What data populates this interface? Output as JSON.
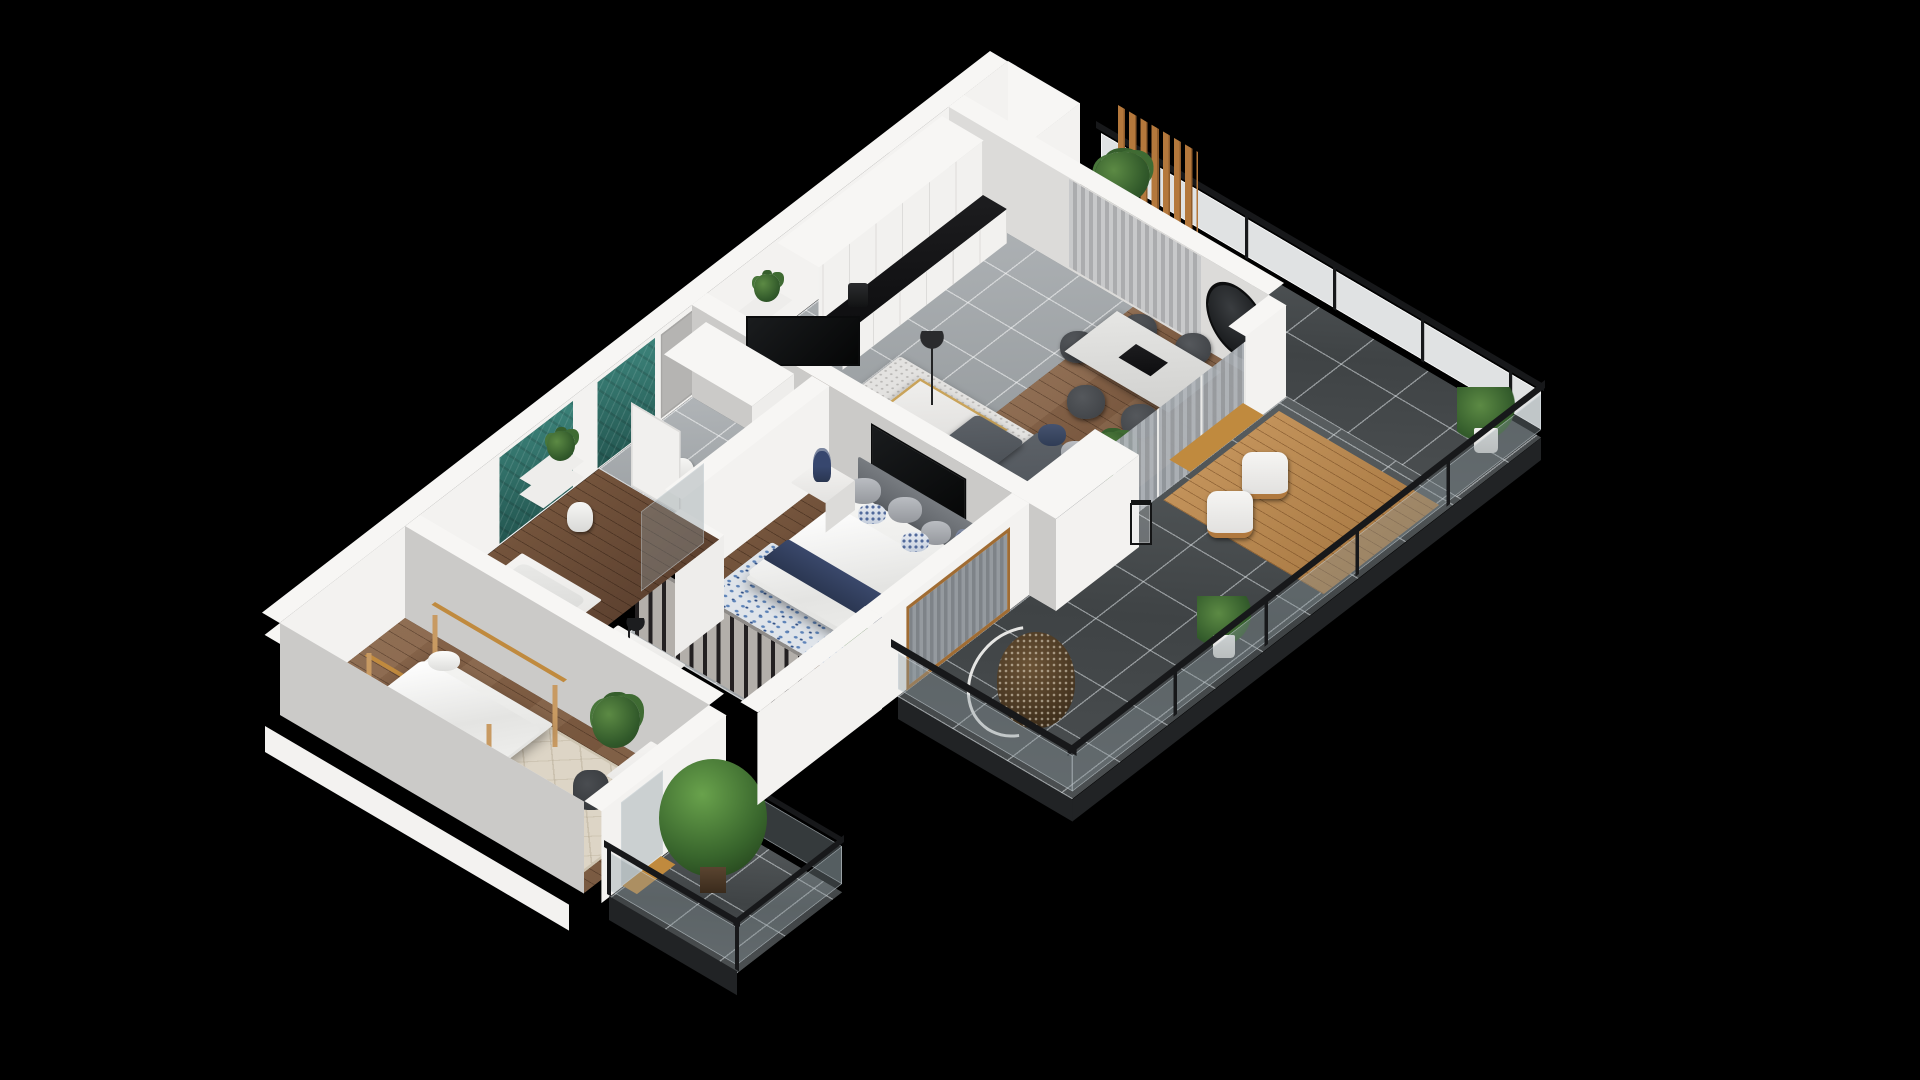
{
  "scene": {
    "type": "isometric-3d-floor-plan",
    "background": "#000000",
    "description": "Cutaway 3D rendering of a two-bedroom apartment with open-plan kitchen/living room, wrap-around tiled terrace with glass railing, master bedroom with walk-in wardrobe, two teal-tiled bathrooms, kids bedroom and a small tree balcony",
    "visible_text": []
  },
  "palette": {
    "background": "#000000",
    "wall_top": "#f7f6f4",
    "wall_lit": "#f3f2f0",
    "wall_shade": "#cbcac8",
    "terrace_tile": "#4d5153",
    "indoor_tile": "#a6abae",
    "wood_floor": "#7e5c41",
    "wood_accent": "#b4783c",
    "teal_tile": "#2e6e67",
    "railing_black": "#17181a",
    "glass": "rgba(140,152,158,0.38)",
    "sofa_gray": "#4f545a",
    "navy_accent": "#33415e",
    "rug_blue": "#5d83b8",
    "rug_beige": "#ddd5c6",
    "counter_black": "#141416",
    "gold_accent": "#c9a35a",
    "plant_green": "#4a7a3a"
  },
  "rooms": [
    {
      "name": "kitchen-dining-living",
      "floors": [
        "gray-tile",
        "wood"
      ],
      "items": [
        "kitchen-cabinets",
        "black-countertop",
        "coffee-machine",
        "dining-table",
        "dining-chairs-x5",
        "round-wall-mirror",
        "window-curtains",
        "sliding-glass-doors",
        "sofa",
        "coffee-table",
        "area-rug",
        "floor-lamp",
        "wall-tv",
        "plant"
      ]
    },
    {
      "name": "terrace",
      "floors": [
        "dark-tile",
        "wood-deck"
      ],
      "items": [
        "glass-railing",
        "wood-slat-screen",
        "outdoor-table",
        "lounge-chairs-x2",
        "lanterns",
        "potted-plants",
        "hanging-egg-chair"
      ]
    },
    {
      "name": "master-bedroom",
      "floors": [
        "wood"
      ],
      "items": [
        "double-bed",
        "headboard",
        "navy-throw",
        "pillows",
        "nightstands-x2",
        "navy-lamps-x2",
        "blue-rug",
        "wall-tv",
        "window",
        "curtains",
        "plant"
      ]
    },
    {
      "name": "walk-in-wardrobe",
      "floors": [
        "gray-tile"
      ],
      "items": [
        "hanging-clothes-rail",
        "white-cabinet",
        "desk",
        "desk-lamp"
      ]
    },
    {
      "name": "entrance-hall-wc",
      "floors": [
        "gray-tile"
      ],
      "items": [
        "entrance-door",
        "teal-tile-wall",
        "tall-cabinet",
        "toilet",
        "shelves",
        "plant",
        "open-doors"
      ]
    },
    {
      "name": "bathroom",
      "floors": [
        "wood"
      ],
      "items": [
        "teal-tile-wall",
        "wall-hung-toilet",
        "shelves",
        "plant",
        "shower-glass",
        "bathtub"
      ]
    },
    {
      "name": "kids-bedroom",
      "floors": [
        "wood"
      ],
      "items": [
        "house-frame-bed",
        "beige-rug",
        "plant",
        "desk",
        "chair",
        "curtains"
      ]
    },
    {
      "name": "balcony",
      "floors": [
        "dark-tile"
      ],
      "items": [
        "glass-railing-black-frame",
        "potted-tree",
        "wood-threshold"
      ]
    }
  ]
}
